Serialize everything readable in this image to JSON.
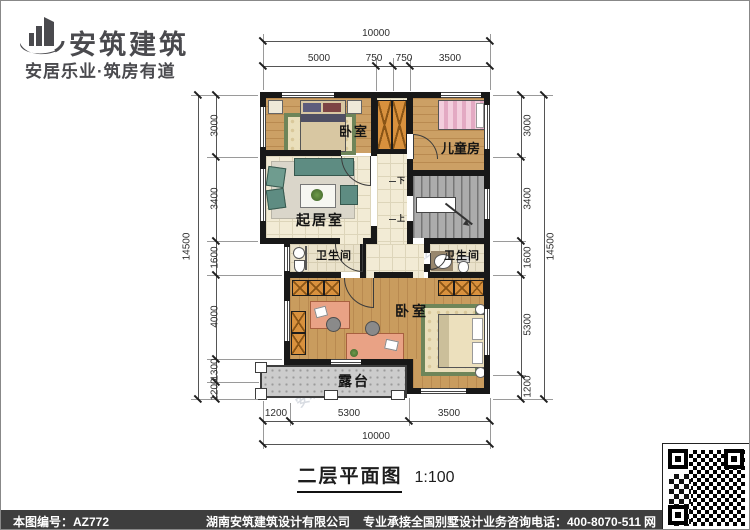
{
  "header": {
    "brand": "安筑建筑",
    "slogan": "安居乐业·筑房有道",
    "logo_icon": "building-logo-icon",
    "brand_color": "#4a4a4e"
  },
  "plan": {
    "rooms": {
      "bedroom_top": "卧室",
      "children": "儿童房",
      "living": "起居室",
      "bath_left": "卫生间",
      "bath_right": "卫生间",
      "bedroom_bottom": "卧室",
      "terrace": "露台"
    },
    "stairs": {
      "down": "下",
      "up": "上"
    },
    "dims": {
      "top_total": "10000",
      "top_segments": [
        "5000",
        "750",
        "750",
        "3500"
      ],
      "bottom_segments": [
        "1200",
        "5300",
        "3500"
      ],
      "bottom_total": "10000",
      "left_total": "14500",
      "left_segments": [
        "3000",
        "3400",
        "1600",
        "4000",
        "1300",
        "1200"
      ],
      "right_total": "14500",
      "right_segments": [
        "3000",
        "3400",
        "1600",
        "5300",
        "1200"
      ]
    }
  },
  "title": {
    "name": "二层平面图",
    "scale": "1:100"
  },
  "watermark": {
    "text": "安筑建筑hnaz.com"
  },
  "footer": {
    "sheet_no": "本图编号：AZ772",
    "company": "湖南安筑建筑设计有限公司",
    "service": "专业承接全国别墅设计业务",
    "phone": "咨询电话：400-8070-511",
    "web": "网",
    "qr_icon": "qr-code"
  },
  "colors": {
    "wall": "#181818",
    "wood_floor": "#cfa468",
    "tile_floor": "#f2ebd5",
    "bath_tile": "#eae2cb",
    "stairs_gray": "#acacac",
    "terrace_gray": "#cccccc",
    "wardrobe_orange": "#d9913d",
    "rug_green": "#6e8559",
    "footer_bar": "#3e3e3e",
    "brand_gray": "#4a4a4e"
  }
}
